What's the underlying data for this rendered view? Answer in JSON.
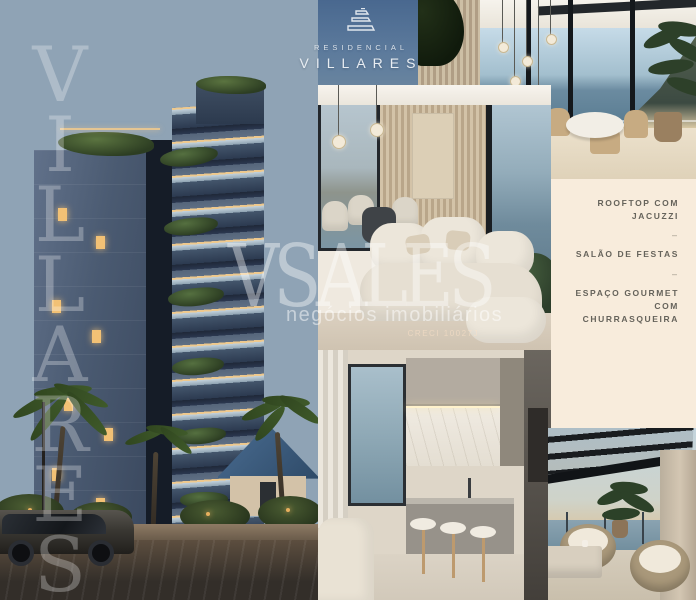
{
  "logo": {
    "icon": "villares-building-icon",
    "line1": "RESIDENCIAL",
    "line2": "VILLARES"
  },
  "left_watermark": {
    "letters": [
      "V",
      "I",
      "L",
      "L",
      "A",
      "R",
      "E",
      "S"
    ]
  },
  "center_watermark": {
    "brand": "VSALES",
    "tagline": "negócios imobiliários",
    "license": "CRECI 10027J"
  },
  "amenities_panel": {
    "items": [
      "ROOFTOP COM JACUZZI",
      "SALÃO DE FESTAS",
      "ESPAÇO GOURMET COM CHURRASQUEIRA"
    ],
    "separator": "–",
    "background": "#f8ecdc",
    "text_color": "#66635b"
  },
  "palette": {
    "sky_top": "#49688f",
    "sky_horizon": "#c7ad8d",
    "facade_dark": "#2c3a50",
    "window_glow": "#f2c175",
    "foliage": "#3f5a2a",
    "cream_panel": "#f8ecdc",
    "ocean": "#6f8b9c",
    "watermark_white": "rgba(255,255,255,0.4)"
  },
  "photos": {
    "building": "building-exterior-dusk",
    "terrace": "terrace-dining-ocean-view",
    "living": "living-room-interior",
    "kitchen": "kitchen-interior",
    "rooftop": "rooftop-lounge-ocean-view"
  }
}
